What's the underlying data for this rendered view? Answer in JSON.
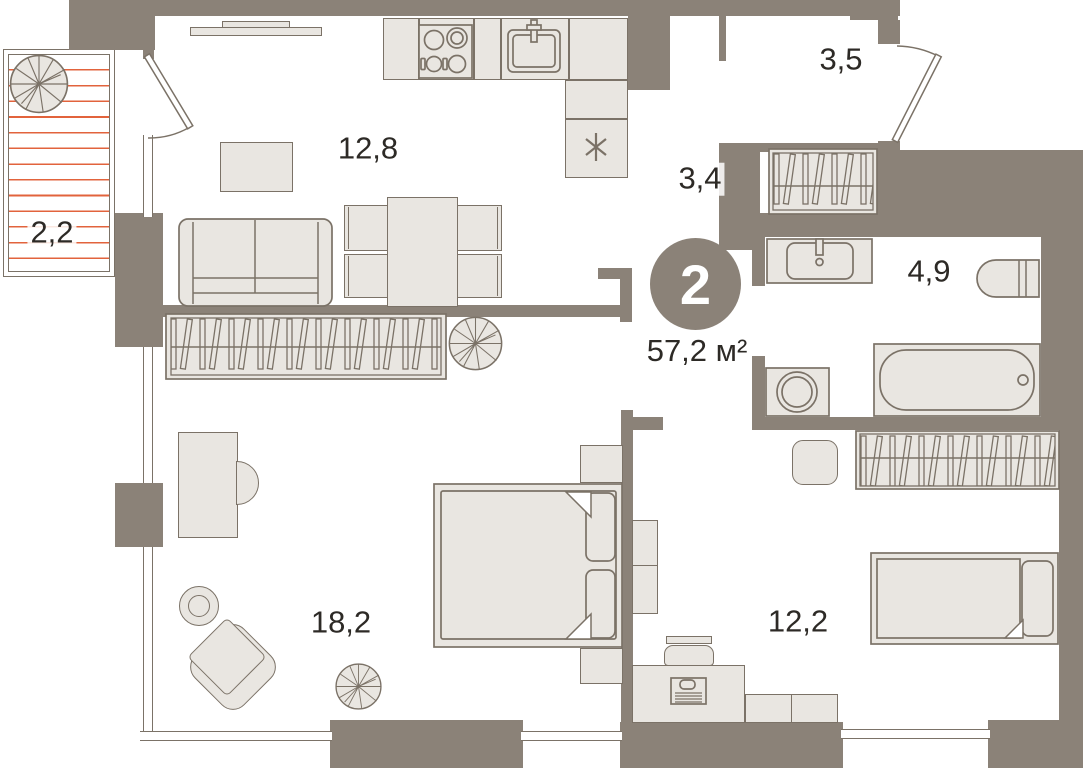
{
  "badge": {
    "rooms_count": "2",
    "total_area": "57,2 м²"
  },
  "rooms": [
    {
      "id": "balcony",
      "area_label": "2,2"
    },
    {
      "id": "living-kitchen",
      "area_label": "12,8"
    },
    {
      "id": "hallway",
      "area_label": "3,4"
    },
    {
      "id": "entry-hall",
      "area_label": "3,5"
    },
    {
      "id": "bathroom",
      "area_label": "4,9"
    },
    {
      "id": "bedroom",
      "area_label": "18,2"
    },
    {
      "id": "second-room",
      "area_label": "12,2"
    }
  ],
  "icons": {
    "fridge-icon": "six-spoke snowflake asterisk",
    "plant-icon": "circle with radial segments",
    "wardrobe-icon": "rail with hanger slats",
    "door-icon": "door leaf with swing arc",
    "stove-icon": "four burner circles",
    "sink-icon": "basin with tap",
    "toilet-icon": "bowl with cistern lines",
    "bathtub-icon": "rounded tub with drain",
    "washing-machine-icon": "square with porthole circles"
  },
  "colors": {
    "wall": "#8b8278",
    "ffill": "#e9e6e1",
    "line": "#7b7267",
    "hatch": "#e2633c",
    "text": "#2d2a26",
    "bg": "#ffffff"
  }
}
